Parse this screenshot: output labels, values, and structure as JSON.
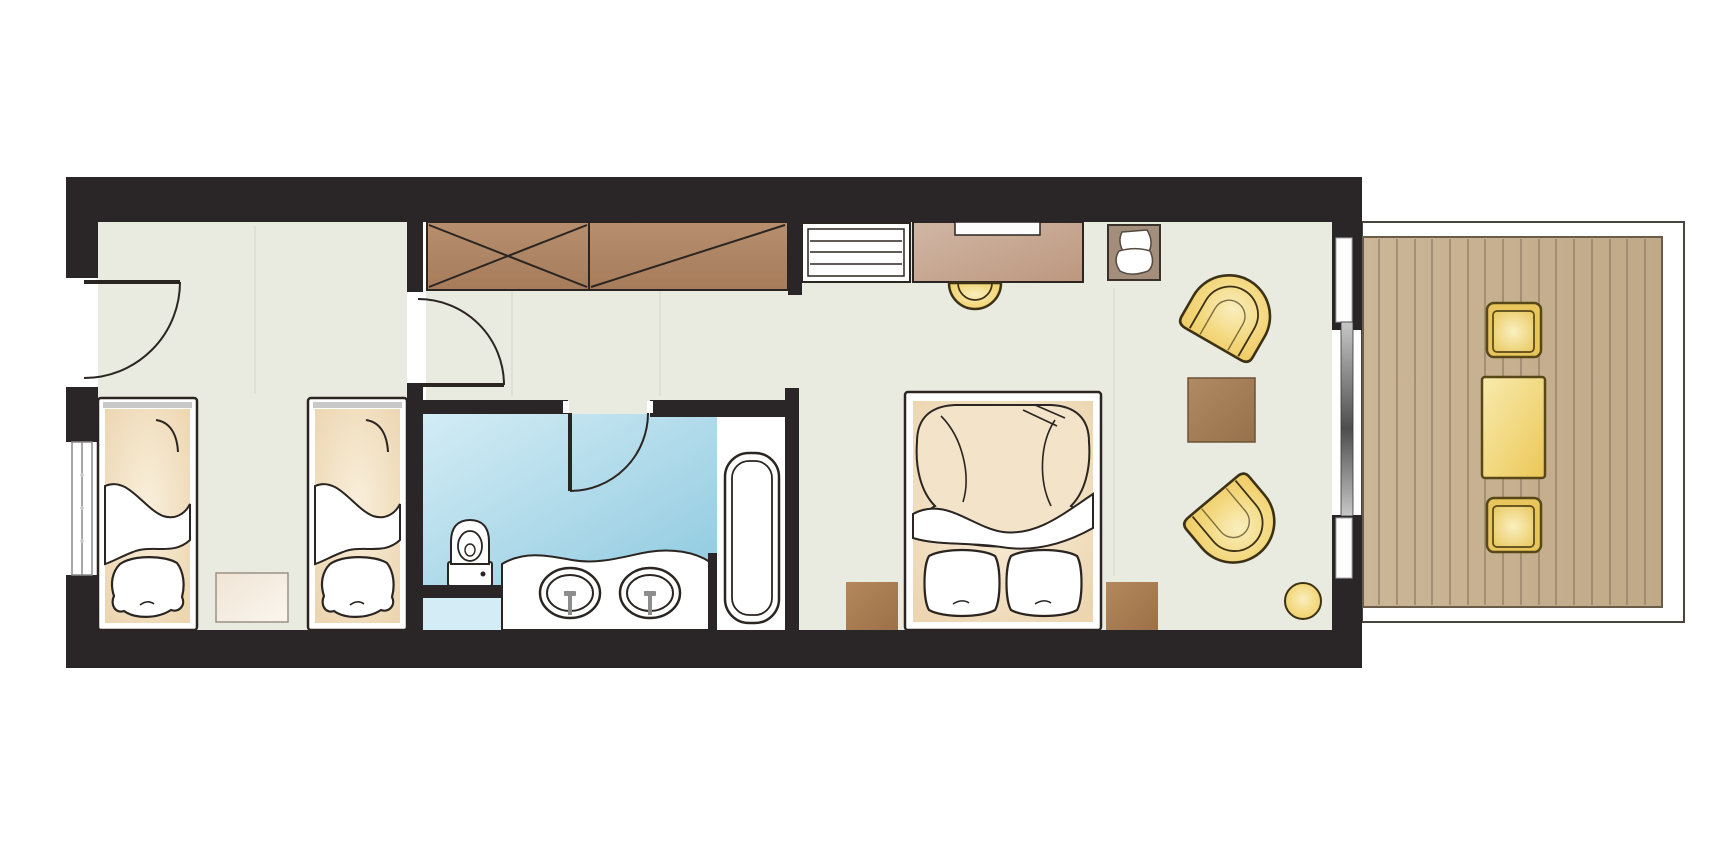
{
  "meta": {
    "title": "Hotel suite floor plan",
    "type": "architectural floor plan, top view, no text labels"
  },
  "colors": {
    "white": "#ffffff",
    "wall": "#2a2526",
    "outline": "#2b2521",
    "floor": "#e9ebe1",
    "bathA": "#d3ecf5",
    "bathB": "#8fcae0",
    "wood1": "#b78f6e",
    "wood2": "#a67c5b",
    "desk1": "#d0b7a5",
    "desk2": "#bd977f",
    "niche": "#a38d7b",
    "nicheBorder": "#3a322a",
    "brown1": "#b4885c",
    "brown2": "#9c7148",
    "tableA": "#b08a62",
    "tableB": "#96714b",
    "yellowEdge": "#efc95f",
    "yellowMid": "#f3d87e",
    "yellowLight": "#f9eebe",
    "yellowStroke": "#3c3114",
    "deck1": "#cbb697",
    "deck2": "#c0a987",
    "plank": "#8f7c64",
    "deckBorder": "#6b5c49",
    "balconyBorder": "#4a443e",
    "cushionEdge": "#e8c65c",
    "cushionLight": "#faf0c0",
    "cushionStroke": "#584717",
    "btable1": "#f8ebae",
    "btable2": "#ecc757",
    "cream1": "#f0e4d5",
    "cream2": "#fbf6ee",
    "creamStroke": "#9a9186",
    "bedTanEdge": "#ecd5b0",
    "bedTanLight": "#f9efdb",
    "duvet": "#f2e3c9",
    "grayFix": "#8d8d8d",
    "winGray": "#8a8a8a",
    "sliderA": "#c7c7c7",
    "sliderB": "#4e4e4e",
    "jamb": "#fdfdfd"
  },
  "rooms": {
    "children_bedroom": {
      "label": "Children's bedroom with two single beds, bedside table, entry door and window"
    },
    "hallway": {
      "label": "Hallway with built-in wardrobe, slatted luggage bench, desk with stool and lounge chair niche"
    },
    "bathroom": {
      "label": "Bathroom with toilet, double washbasin vanity and bathtub"
    },
    "master_bedroom": {
      "label": "Master bedroom and lounge with double bed, two bedside tables, two armchairs, coffee table, stool and sliding balcony door"
    },
    "balcony": {
      "label": "Balcony with wooden deck, two outdoor chairs and table"
    }
  }
}
